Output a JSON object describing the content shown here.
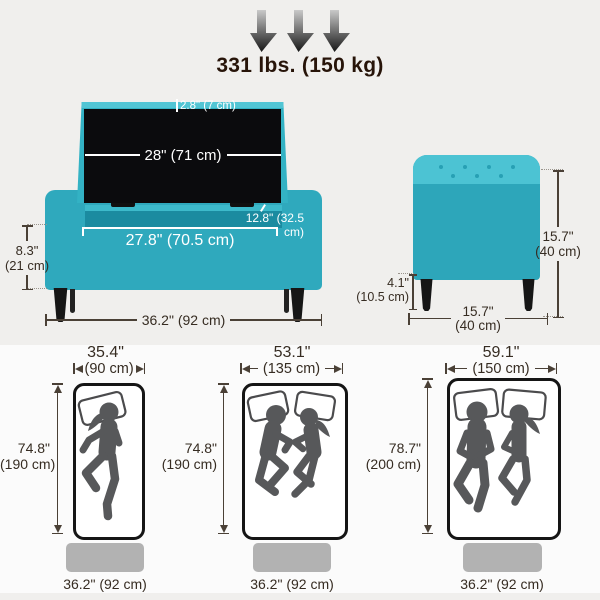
{
  "colors": {
    "teal": "#2fa9bd",
    "teal_light": "#4cc3d3",
    "teal_dark": "#1b8ba0",
    "lid_interior_black": "#0b0b0d",
    "figure_gray": "#57585a",
    "footprint_gray": "#b2b2b2",
    "dimension_text": "#362c22",
    "background_top": "#f0efed",
    "background_bottom": "#fbfbfb"
  },
  "weight_capacity": {
    "label": "331 lbs. (150 kg)"
  },
  "ottoman_front_view": {
    "lid_thickness": "2.8\" (7 cm)",
    "lid_width": "28\" (71 cm)",
    "opening_depth": "12.8\" (32.5 cm)",
    "opening_width": "27.8\" (70.5 cm)",
    "base_height_in": "8.3\"",
    "base_height_cm": "(21 cm)",
    "overall_width": "36.2\" (92 cm)"
  },
  "ottoman_side_view": {
    "overall_height_in": "15.7\"",
    "overall_height_cm": "(40 cm)",
    "depth_in": "15.7\"",
    "depth_cm": "(40 cm)",
    "leg_height_in": "4.1\"",
    "leg_height_cm": "(10.5 cm)"
  },
  "mattress_comparison": {
    "mattresses": [
      {
        "width_in": "35.4\"",
        "width_cm": "(90 cm)",
        "length_in": "74.8\"",
        "length_cm": "(190 cm)",
        "persons": 1,
        "ottoman_width": "36.2\" (92 cm)"
      },
      {
        "width_in": "53.1\"",
        "width_cm": "(135 cm)",
        "length_in": "74.8\"",
        "length_cm": "(190 cm)",
        "persons": 2,
        "ottoman_width": "36.2\" (92 cm)"
      },
      {
        "width_in": "59.1\"",
        "width_cm": "(150 cm)",
        "length_in": "78.7\"",
        "length_cm": "(200 cm)",
        "persons": 2,
        "ottoman_width": "36.2\" (92 cm)"
      }
    ]
  }
}
